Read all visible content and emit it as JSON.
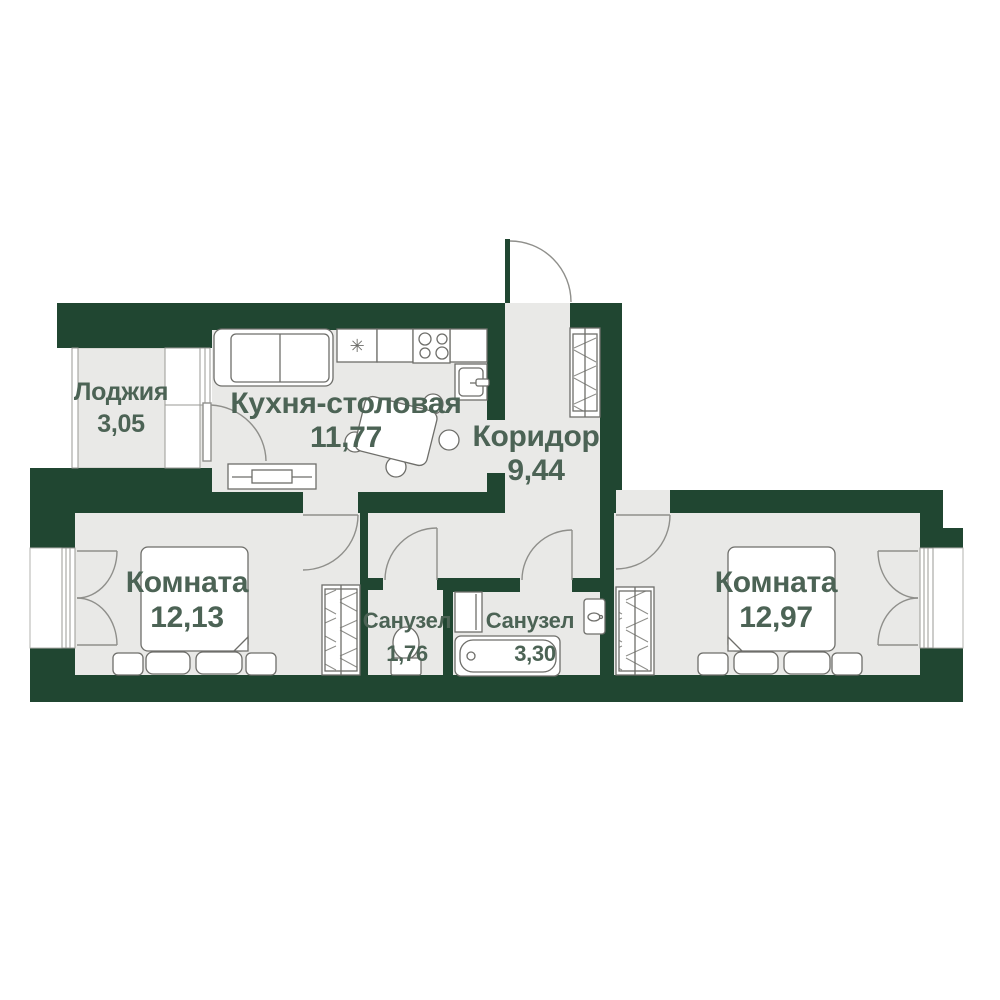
{
  "plan": {
    "rooms": [
      {
        "name": "Лоджия",
        "area": "3,05"
      },
      {
        "name": "Кухня-столовая",
        "area": "11,77"
      },
      {
        "name": "Коридор",
        "area": "9,44"
      },
      {
        "name": "Комната",
        "area": "12,13"
      },
      {
        "name": "Санузел",
        "area": "1,76"
      },
      {
        "name": "Санузел",
        "area": "3,30"
      },
      {
        "name": "Комната",
        "area": "12,97"
      }
    ],
    "symbols": {
      "sink_mark": "✳"
    },
    "colors": {
      "wall": "#204631",
      "floor": "#e9e9e7",
      "label": "#4c6355",
      "furniture_stroke": "#6e6e6a",
      "door_stroke": "#8f8f8b",
      "thin_outline": "#b3b3af"
    }
  }
}
